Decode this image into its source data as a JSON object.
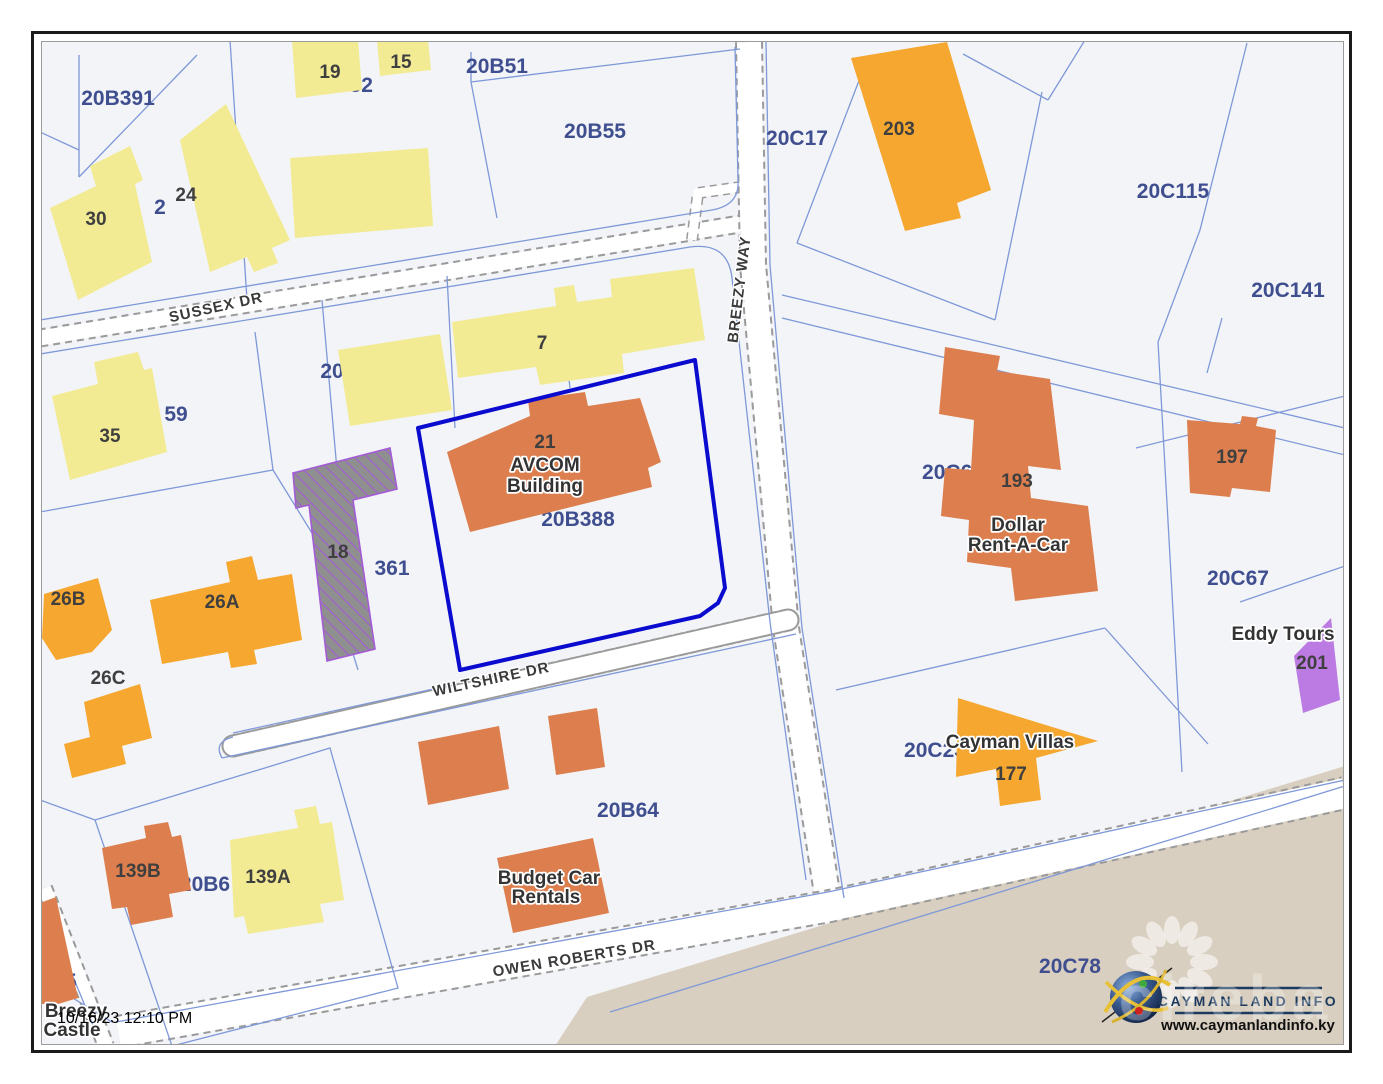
{
  "theme": {
    "map_bg": "#F3F4F7",
    "road_fill": "#FFFFFF",
    "road_casing": "#9A9A9A",
    "parcel_line": "#7E98D8",
    "parcel_label": "#3E4E8F",
    "building_label": "#3F3F3F",
    "halo_text": "#333333",
    "highlight_outline": "#0B0BD0",
    "building_yellow": "#F2EB94",
    "building_amber": "#F5A72F",
    "building_terracotta": "#DC7E4D",
    "building_purple": "#BB7BE2",
    "hatch_fill": "#8F8F8F",
    "hatch_line": "#A35BD6",
    "shore_tan": "#D9CFC0",
    "logo_navy": "#1C3A5E",
    "frame_black": "#1A1A1A",
    "frame_gray": "#9B9B9B",
    "timestamp_color": "#000000"
  },
  "streets": [
    {
      "label": "SUSSEX DR"
    },
    {
      "label": "BREEZY WAY"
    },
    {
      "label": "WILTSHIRE DR"
    },
    {
      "label": "OWEN ROBERTS DR"
    }
  ],
  "parcels": [
    {
      "label": "20B391"
    },
    {
      "label": "20B52"
    },
    {
      "label": "20B51"
    },
    {
      "label": "20B55"
    },
    {
      "label": "20C17"
    },
    {
      "label": "20C16"
    },
    {
      "label": "20C115"
    },
    {
      "label": "20C141"
    },
    {
      "label": "2"
    },
    {
      "label": "20"
    },
    {
      "label": "59"
    },
    {
      "label": "20B388"
    },
    {
      "label": "361"
    },
    {
      "label": "20C66"
    },
    {
      "label": "20C67"
    },
    {
      "label": "20B64"
    },
    {
      "label": "20B6"
    },
    {
      "label": "20C23"
    },
    {
      "label": "20C78"
    },
    {
      "label": "125"
    }
  ],
  "buildings": [
    {
      "label": "30"
    },
    {
      "label": "24"
    },
    {
      "label": "19"
    },
    {
      "label": "15"
    },
    {
      "label": "7"
    },
    {
      "label": "35"
    },
    {
      "label": "26A"
    },
    {
      "label": "26B"
    },
    {
      "label": "26C"
    },
    {
      "label": "18"
    },
    {
      "label": "21"
    },
    {
      "label": "203"
    },
    {
      "label": "193"
    },
    {
      "label": "197"
    },
    {
      "label": "177"
    },
    {
      "label": "201"
    },
    {
      "label": "139A"
    },
    {
      "label": "139B"
    }
  ],
  "places": [
    {
      "label": "AVCOM"
    },
    {
      "label": "Building"
    },
    {
      "label": "Dollar"
    },
    {
      "label": "Rent-A-Car"
    },
    {
      "label": "Budget Car"
    },
    {
      "label": "Rentals"
    },
    {
      "label": "Cayman Villas"
    },
    {
      "label": "Eddy Tours"
    },
    {
      "label": "Breezy"
    },
    {
      "label": "Castle"
    }
  ],
  "status": {
    "timestamp": "10/16/23 12:10 PM"
  },
  "logo": {
    "name": "CAYMAN LAND INFO",
    "website": "www.caymanlandinfo.ky"
  },
  "watermark": {
    "text": "cireba"
  }
}
